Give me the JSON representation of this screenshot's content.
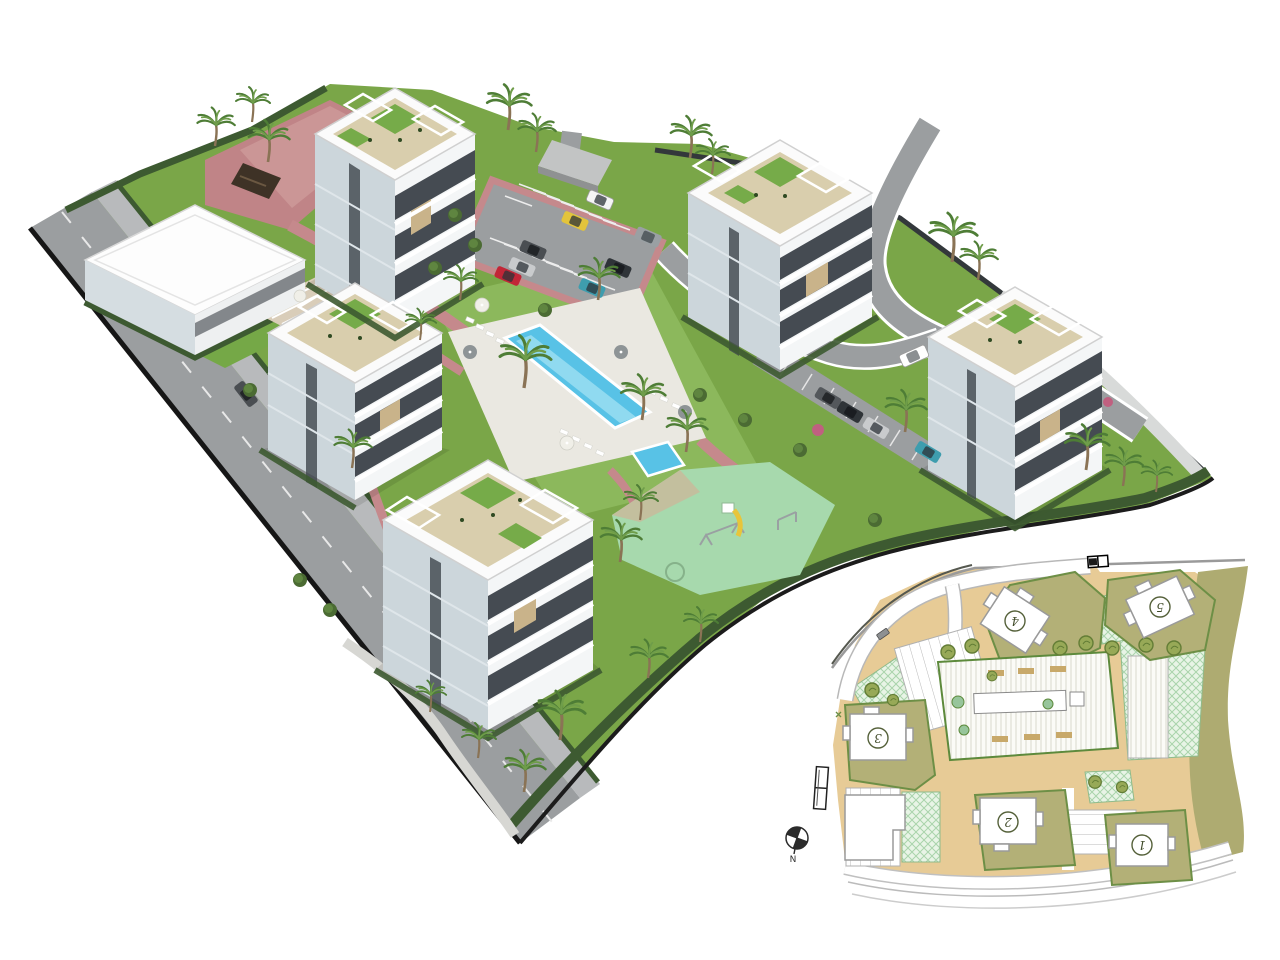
{
  "site_plan": {
    "buildings": [
      {
        "id": "plot-1",
        "label": "1"
      },
      {
        "id": "plot-2",
        "label": "2"
      },
      {
        "id": "plot-3",
        "label": "3"
      },
      {
        "id": "plot-4",
        "label": "4"
      },
      {
        "id": "plot-5",
        "label": "5"
      }
    ],
    "compass_label": "N"
  },
  "colors": {
    "background": "#ffffff",
    "grass": "#7aa648",
    "grass_light": "#8cb85c",
    "hedge": "#3d5a31",
    "road": "#9b9ea0",
    "road_edge": "#161616",
    "paving_pink": "#c08487",
    "paving_pink_light": "#d4a5a3",
    "pool_water": "#58c2e6",
    "pool_lane": "#9fe0f2",
    "deck": "#eae8e1",
    "playground": "#a7d9ad",
    "building_white": "#f4f6f7",
    "building_shade": "#ccd6db",
    "window_dark": "#454b52",
    "wood_accent": "#c9b38a",
    "roof_deck": "#d9cead",
    "plan_tan": "#e7cb96",
    "plan_olive": "#b3b077",
    "plan_green_line": "#6d8f46",
    "plan_mint": "#e8f4e6",
    "plan_tree": "#97a957"
  }
}
